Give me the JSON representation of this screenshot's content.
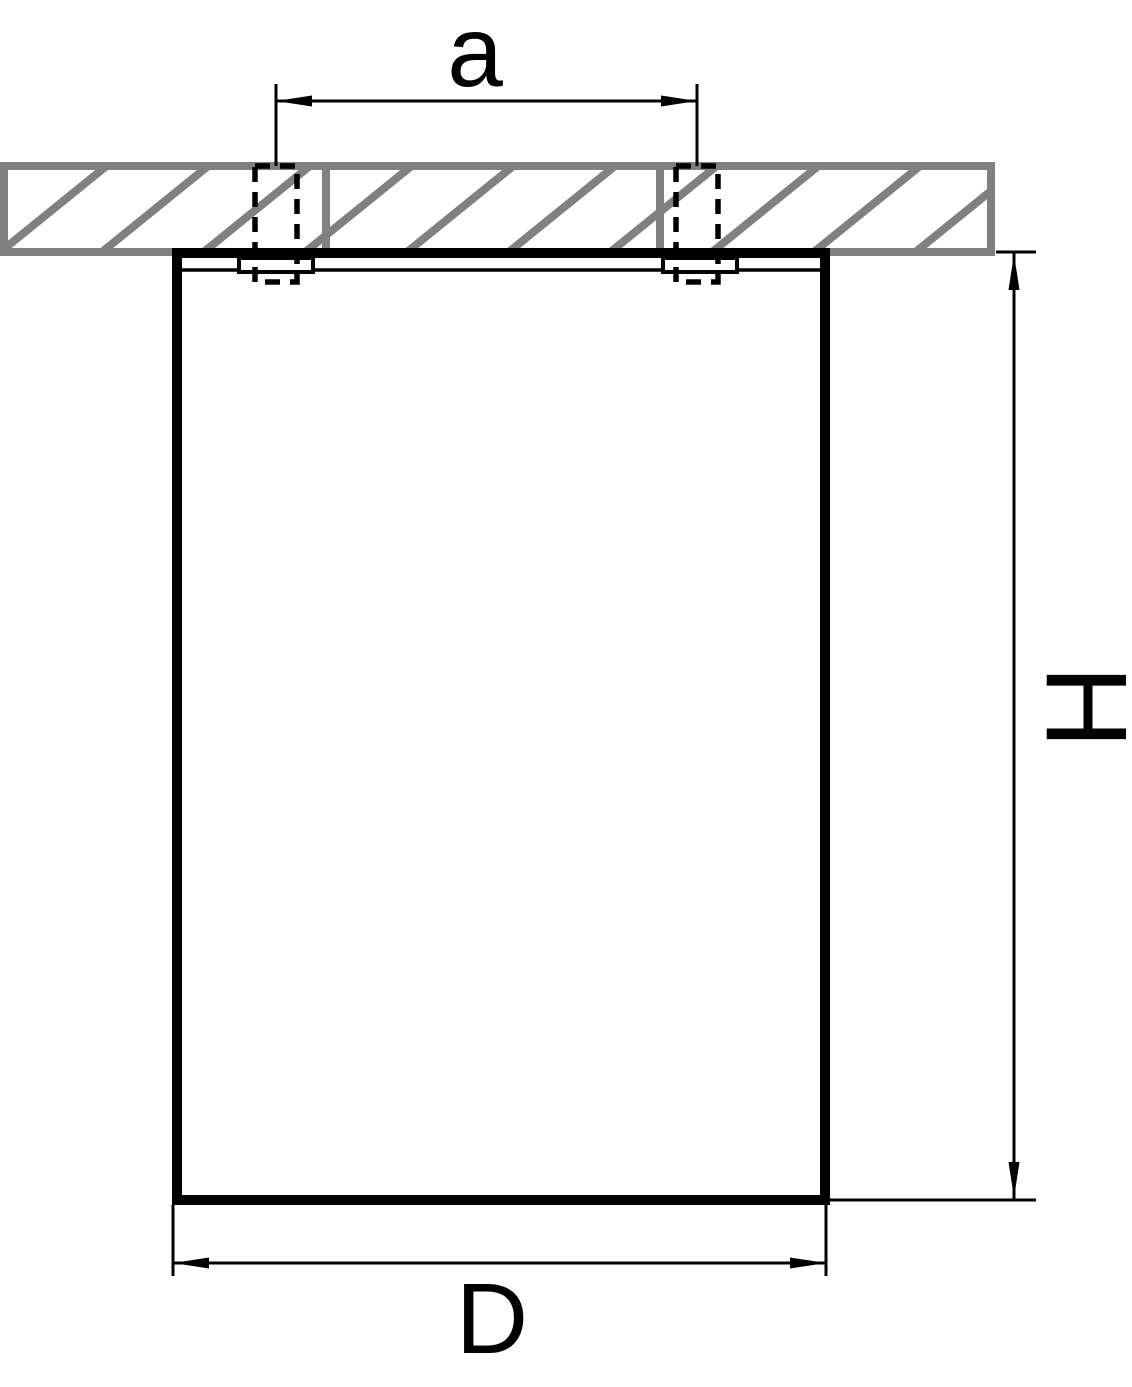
{
  "drawing": {
    "kind": "technical-dimension-drawing",
    "subject": "ceiling-mounted cylindrical luminaire, side section view",
    "labels": {
      "a": "a",
      "H": "H",
      "D": "D"
    },
    "colors": {
      "line": "#000000",
      "ceiling_hatch": "#808080",
      "background": "#ffffff"
    }
  }
}
